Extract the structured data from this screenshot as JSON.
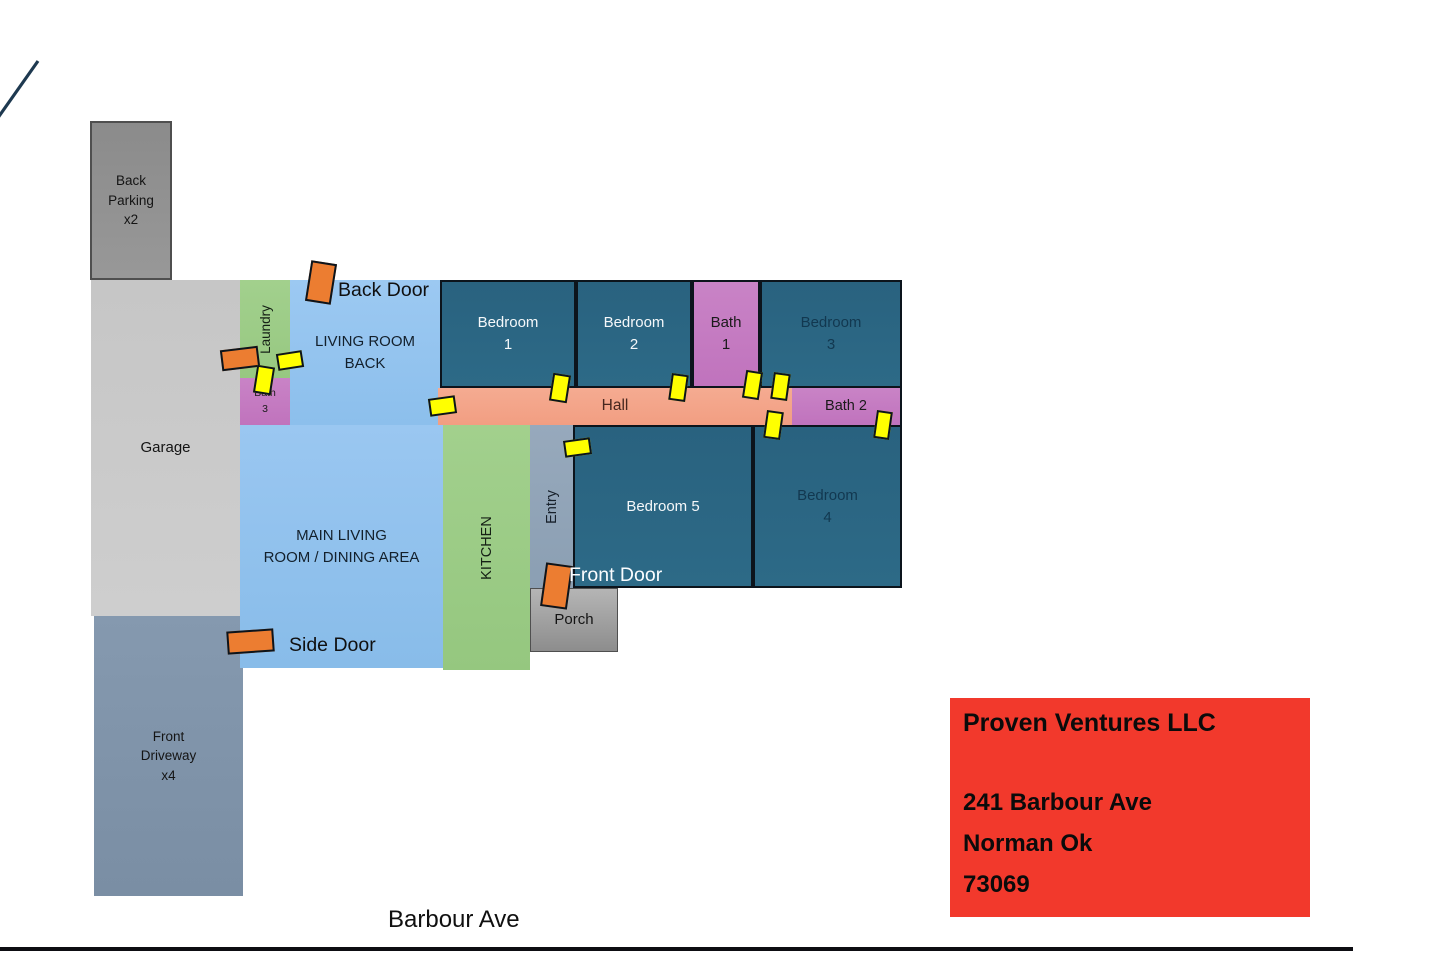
{
  "rooms": {
    "back_parking": "Back\nParking\nx2",
    "garage": "Garage",
    "front_driveway": "Front\nDriveway\nx4",
    "laundry": "Laundry",
    "bath_3": "Bath\n3",
    "living_room_back": "LIVING ROOM\nBACK",
    "main_living": "MAIN LIVING\nROOM / DINING AREA",
    "kitchen": "KITCHEN",
    "entry": "Entry",
    "porch": "Porch",
    "hall": "Hall",
    "bath_1": "Bath\n1",
    "bath_2": "Bath 2",
    "bedroom_1": "Bedroom\n1",
    "bedroom_2": "Bedroom\n2",
    "bedroom_3": "Bedroom\n3",
    "bedroom_4": "Bedroom\n4",
    "bedroom_5": "Bedroom 5"
  },
  "door_labels": {
    "back": "Back Door",
    "side": "Side Door",
    "front": "Front Door"
  },
  "street_label": "Barbour Ave",
  "info_box": {
    "company": "Proven Ventures LLC",
    "address_line_1": "241 Barbour Ave",
    "address_line_2": "Norman Ok",
    "address_line_3": "73069"
  },
  "exterior_door_markers": [
    "back-door",
    "laundry-side-door",
    "side-door",
    "front-door"
  ],
  "interior_door_markers": [
    "hall-west",
    "bedroom-1",
    "bedroom-2",
    "bath-1-left",
    "bath-1-right",
    "bedroom-4-northwest",
    "bedroom-4-northeast",
    "entry",
    "laundry",
    "bath-3"
  ],
  "colors": {
    "bedroom_fill": "#2a6480",
    "bath_fill": "#c57dc2",
    "hall_fill": "#f4a68c",
    "green_fill": "#9ccd88",
    "light_blue_fill": "#90c3ee",
    "entry_fill": "#92a5ba",
    "garage_fill": "#c9c9c9",
    "driveway_fill": "#8095ab",
    "parking_fill": "#909090",
    "porch_fill": "#a3a3a3",
    "exterior_door_marker": "#ec7d31",
    "interior_door_marker": "#ffff00",
    "info_box_fill": "#f2392c"
  }
}
